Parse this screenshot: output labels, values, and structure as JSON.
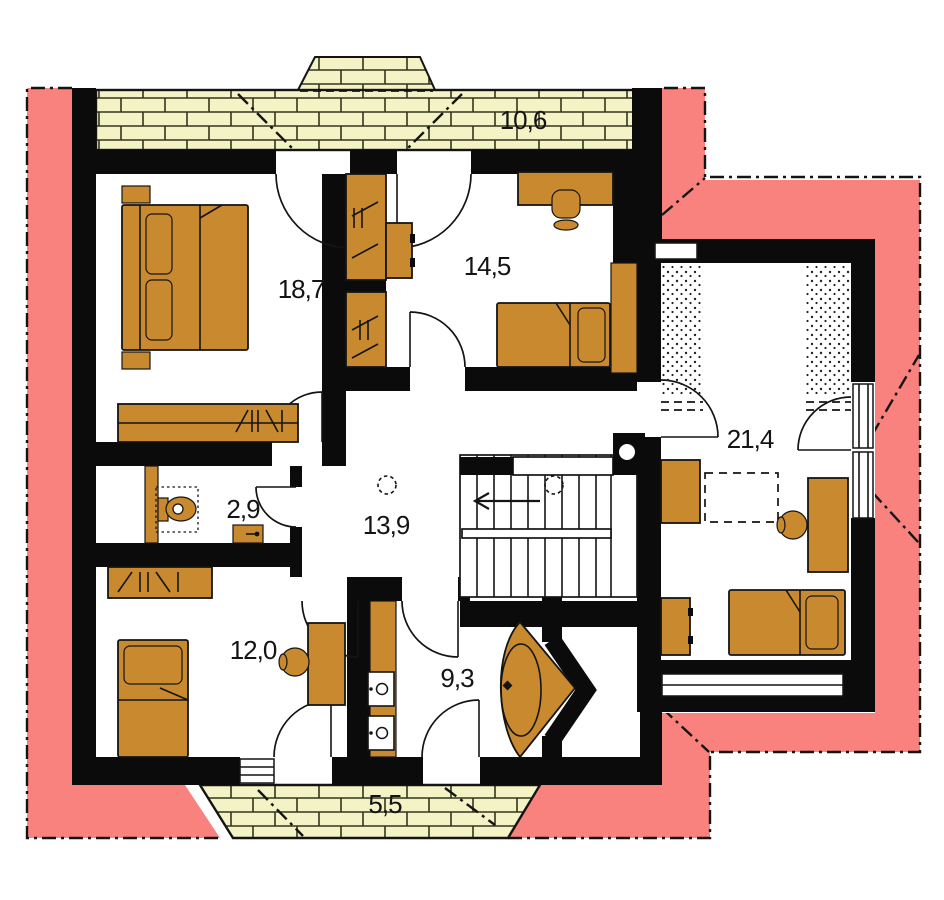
{
  "title": "attic-floor-plan",
  "colors": {
    "roof": "#F9827E",
    "wall": "#0B0B0B",
    "wood": "#C8892F",
    "brick_fill": "#F3F3C6",
    "brick_line": "#35351f",
    "background": "#FFFFFF"
  },
  "rooms": {
    "terrace": {
      "name": "terrace",
      "label": "10,6"
    },
    "bedroom_master": {
      "name": "bedroom-master",
      "label": "18,7"
    },
    "bedroom_upper": {
      "name": "bedroom-upper",
      "label": "14,5"
    },
    "bedroom_right": {
      "name": "bedroom-right",
      "label": "21,4"
    },
    "wc": {
      "name": "wc",
      "label": "2,9"
    },
    "hall": {
      "name": "hall",
      "label": "13,9"
    },
    "bedroom_lower": {
      "name": "bedroom-lower",
      "label": "12,0"
    },
    "bathroom": {
      "name": "bathroom",
      "label": "9,3"
    },
    "balcony": {
      "name": "balcony",
      "label": "5,5"
    }
  },
  "stairs": {
    "direction_arrow": "left"
  }
}
